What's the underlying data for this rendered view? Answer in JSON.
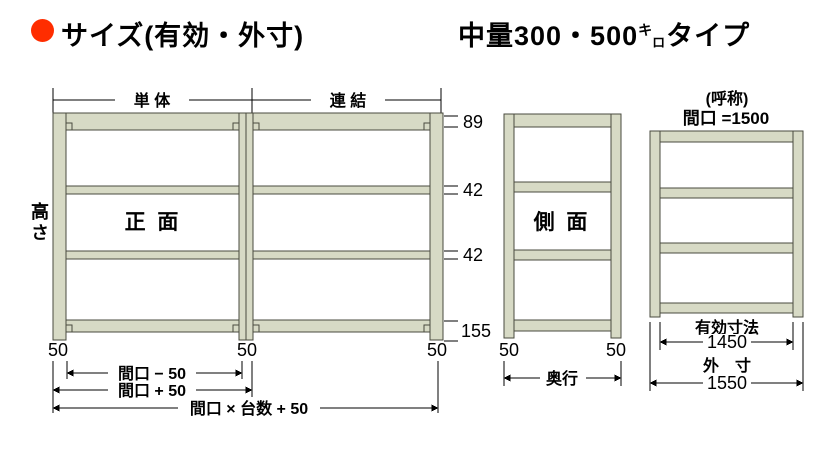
{
  "header": {
    "title_left": "サイズ(有効・外寸)",
    "title_right": {
      "prefix": "中量300・500",
      "kilo_top": "キ",
      "kilo_bottom": "ロ",
      "suffix": "タイプ"
    }
  },
  "front_view": {
    "label": "正 面",
    "height_label": "高さ",
    "span_labels": {
      "single": "単 体",
      "joined": "連 結"
    },
    "side_dims": {
      "top": "89",
      "mid1": "42",
      "mid2": "42",
      "bottom": "155"
    },
    "base_offsets": {
      "left": "50",
      "middle": "50",
      "right": "50"
    },
    "width_dims": {
      "row1": "間口 − 50",
      "row2": "間口 + 50",
      "row3": "間口 × 台数 + 50"
    }
  },
  "side_view": {
    "label": "側 面",
    "base_offsets": {
      "left": "50",
      "right": "50"
    },
    "depth_label": "奥行"
  },
  "unit_view": {
    "caption": "(呼称)",
    "nominal": "間口 =1500",
    "effective_label": "有効寸法",
    "effective_value": "1450",
    "outer_label": "外　寸",
    "outer_value": "1550"
  },
  "colors": {
    "bullet": "#ff2d00",
    "frame_fill": "#d7dac5",
    "frame_stroke": "#4a4b3f",
    "line": "#000000"
  }
}
